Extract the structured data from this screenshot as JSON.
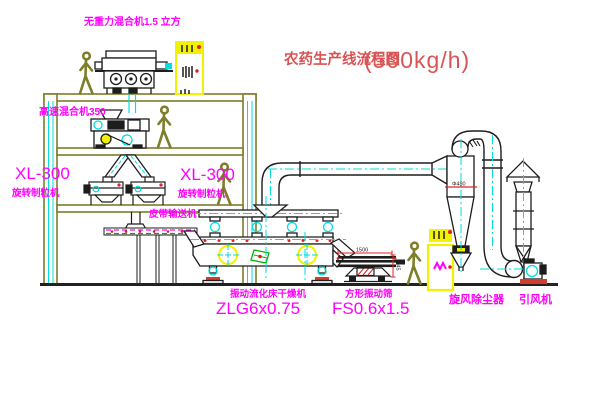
{
  "title": {
    "name": "农药生产线流程图",
    "capacity": "(500kg/h)"
  },
  "equipment_labels": {
    "gravity_free_mixer": "无重力混合机1.5 立方",
    "high_speed_mixer": "高速混合机350",
    "granulator_left_model": "XL-300",
    "granulator_left_name": "旋转制粒机",
    "granulator_right_model": "XL-300",
    "granulator_right_name": "旋转制粒机",
    "belt_conveyor": "皮带输送机",
    "fluid_bed_dryer_name": "振动流化床干燥机",
    "fluid_bed_dryer_model": "ZLG6x0.75",
    "vibrating_screen_name": "方形振动筛",
    "vibrating_screen_model": "FS0.6x1.5",
    "cyclone": "旋风除尘器",
    "fan": "引风机"
  },
  "dimension_annotations": {
    "screen_length": "1500",
    "screen_height": "545",
    "cyclone_diameter": "Φ480"
  },
  "colors": {
    "background": "#ffffff",
    "structure_olive": "#7d7d2a",
    "machine_black": "#1d1d1d",
    "centerline_cyan": "#00dede",
    "label_magenta": "#ff00ff",
    "title_red": "#d95454",
    "accent_red": "#e02020",
    "equipment_yellow": "#f2f200",
    "accent_green": "#00b400"
  }
}
